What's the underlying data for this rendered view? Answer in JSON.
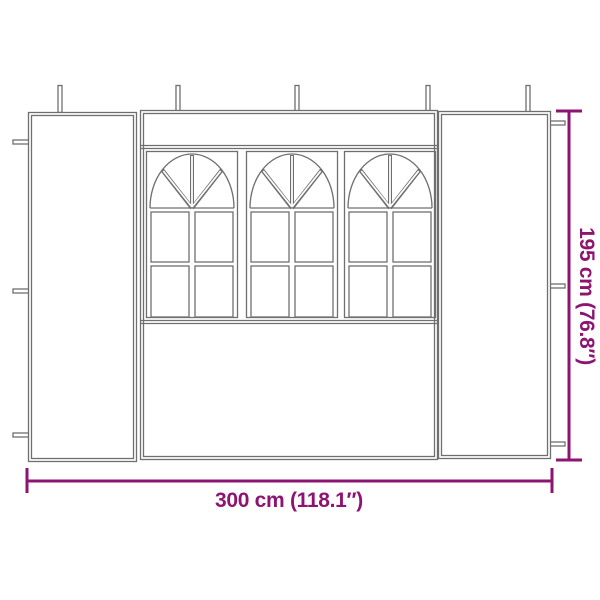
{
  "figure": {
    "type": "product-dimension-diagram",
    "subject": "gazebo sidewall panel with three arched windows"
  },
  "dimensions": {
    "width": {
      "label": "300 cm (118.1″)",
      "cm": 300,
      "inches": 118.1
    },
    "height": {
      "label": "195 cm (76.8″)",
      "cm": 195,
      "inches": 76.8
    }
  },
  "drawing": {
    "windows": 3,
    "panes_per_window": 4,
    "top_pegs": 5,
    "left_tie_tabs": 3,
    "right_tie_tabs": 3
  },
  "colors": {
    "dimension_accent": "#8E1472",
    "line_art": "#6f6f6f",
    "background": "#FFFFFF"
  }
}
